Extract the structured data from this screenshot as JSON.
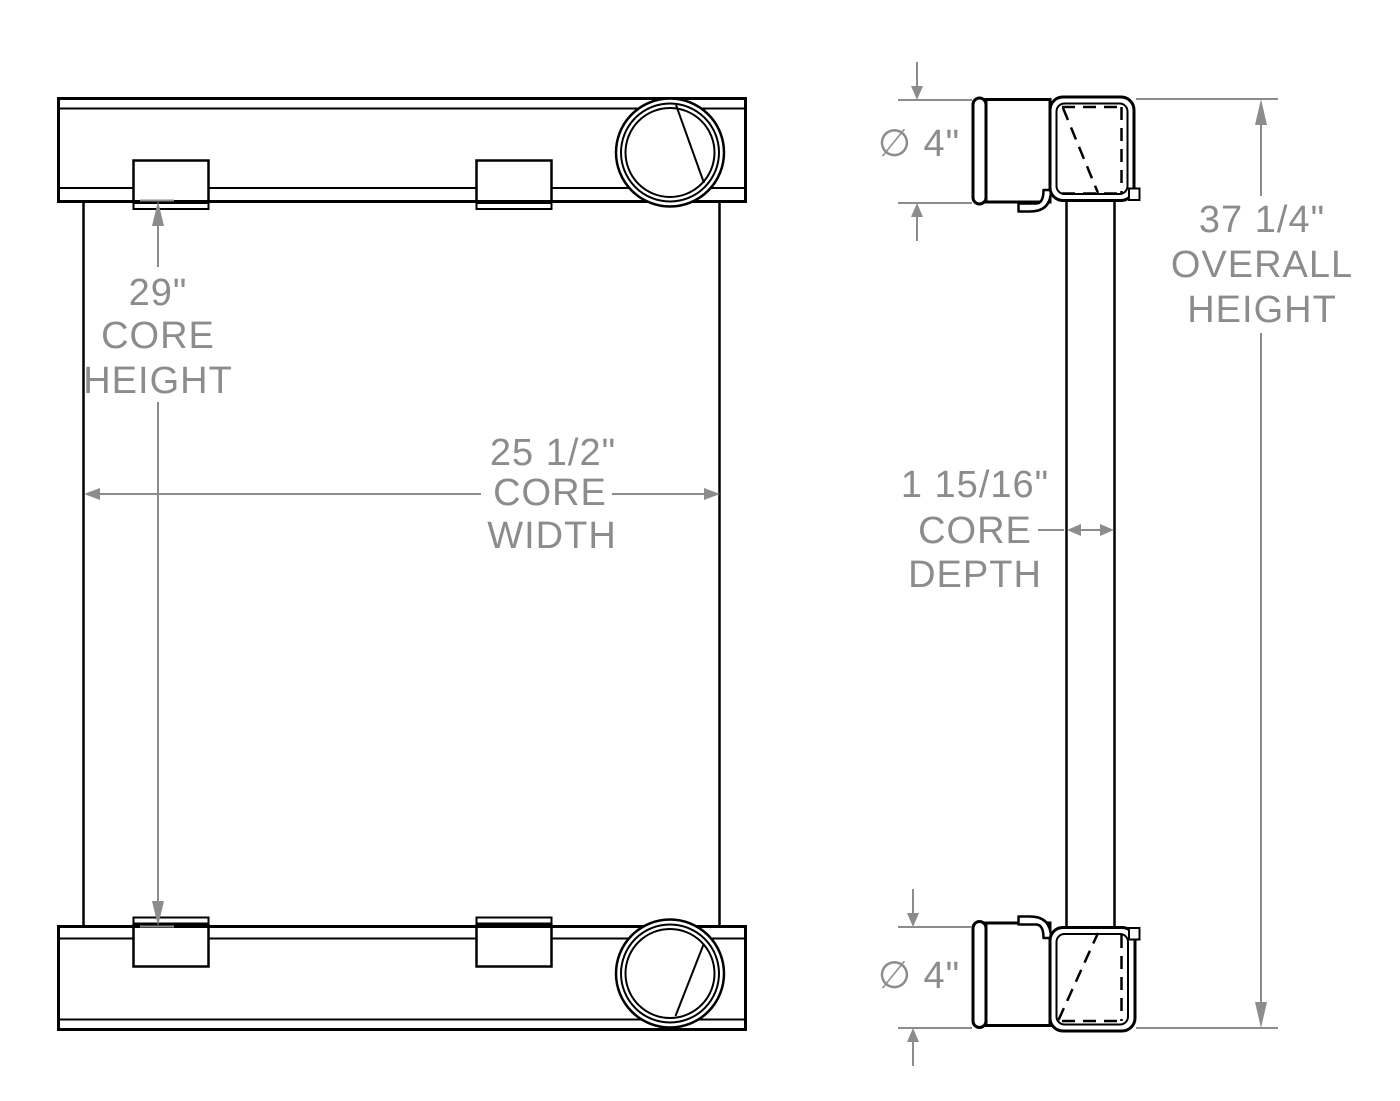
{
  "drawing": {
    "type": "engineering-dimension-drawing",
    "views": [
      "front",
      "side"
    ],
    "colors": {
      "outline": "#000000",
      "dimension": "#8c8c8c",
      "background": "#ffffff"
    }
  },
  "dimensions": {
    "core_height": {
      "value": "29\"",
      "line1": "CORE",
      "line2": "HEIGHT"
    },
    "core_width": {
      "value": "25 1/2\"",
      "line1": "CORE",
      "line2": "WIDTH"
    },
    "overall_height": {
      "value": "37 1/4\"",
      "line1": "OVERALL",
      "line2": "HEIGHT"
    },
    "core_depth": {
      "value": "1 15/16\"",
      "line1": "CORE",
      "line2": "DEPTH"
    },
    "port_top": {
      "value": "∅ 4\""
    },
    "port_bottom": {
      "value": "∅ 4\""
    }
  }
}
